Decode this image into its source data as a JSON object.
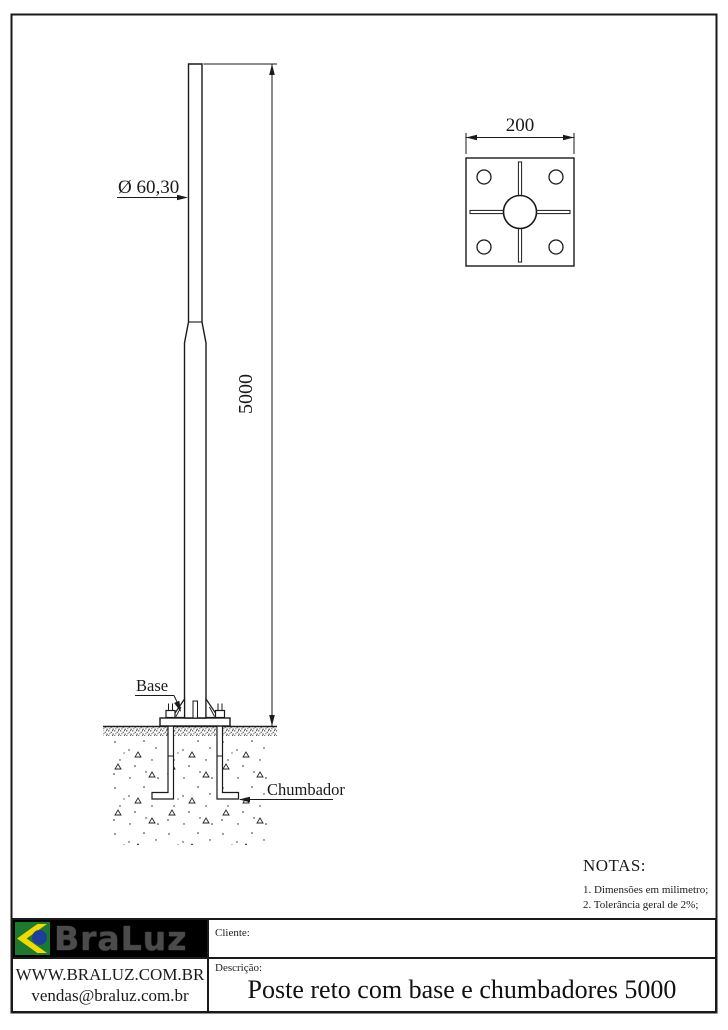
{
  "drawing": {
    "elevation": {
      "diameter_label": "Ø 60,30",
      "height_label": "5000",
      "base_label": "Base",
      "anchor_label": "Chumbador"
    },
    "top_view": {
      "plate_width_label": "200"
    }
  },
  "notes": {
    "heading": "NOTAS:",
    "items": [
      "1. Dimensões em milimetro;",
      "2. Tolerância geral de 2%;"
    ]
  },
  "title_block": {
    "logo_text": "BraLuz",
    "website": "WWW.BRALUZ.COM.BR",
    "email": "vendas@braluz.com.br",
    "client_label": "Cliente:",
    "client_value": "",
    "description_label": "Descrição:",
    "description_value": "Poste reto com base e chumbadores 5000"
  },
  "colors": {
    "line": "#1a1a1a",
    "logo_bg": "#000000",
    "logo_text": "#4b4b4b",
    "flag_green": "#1b7a2f",
    "flag_yellow": "#f2d900",
    "flag_blue": "#1c3f9e"
  }
}
